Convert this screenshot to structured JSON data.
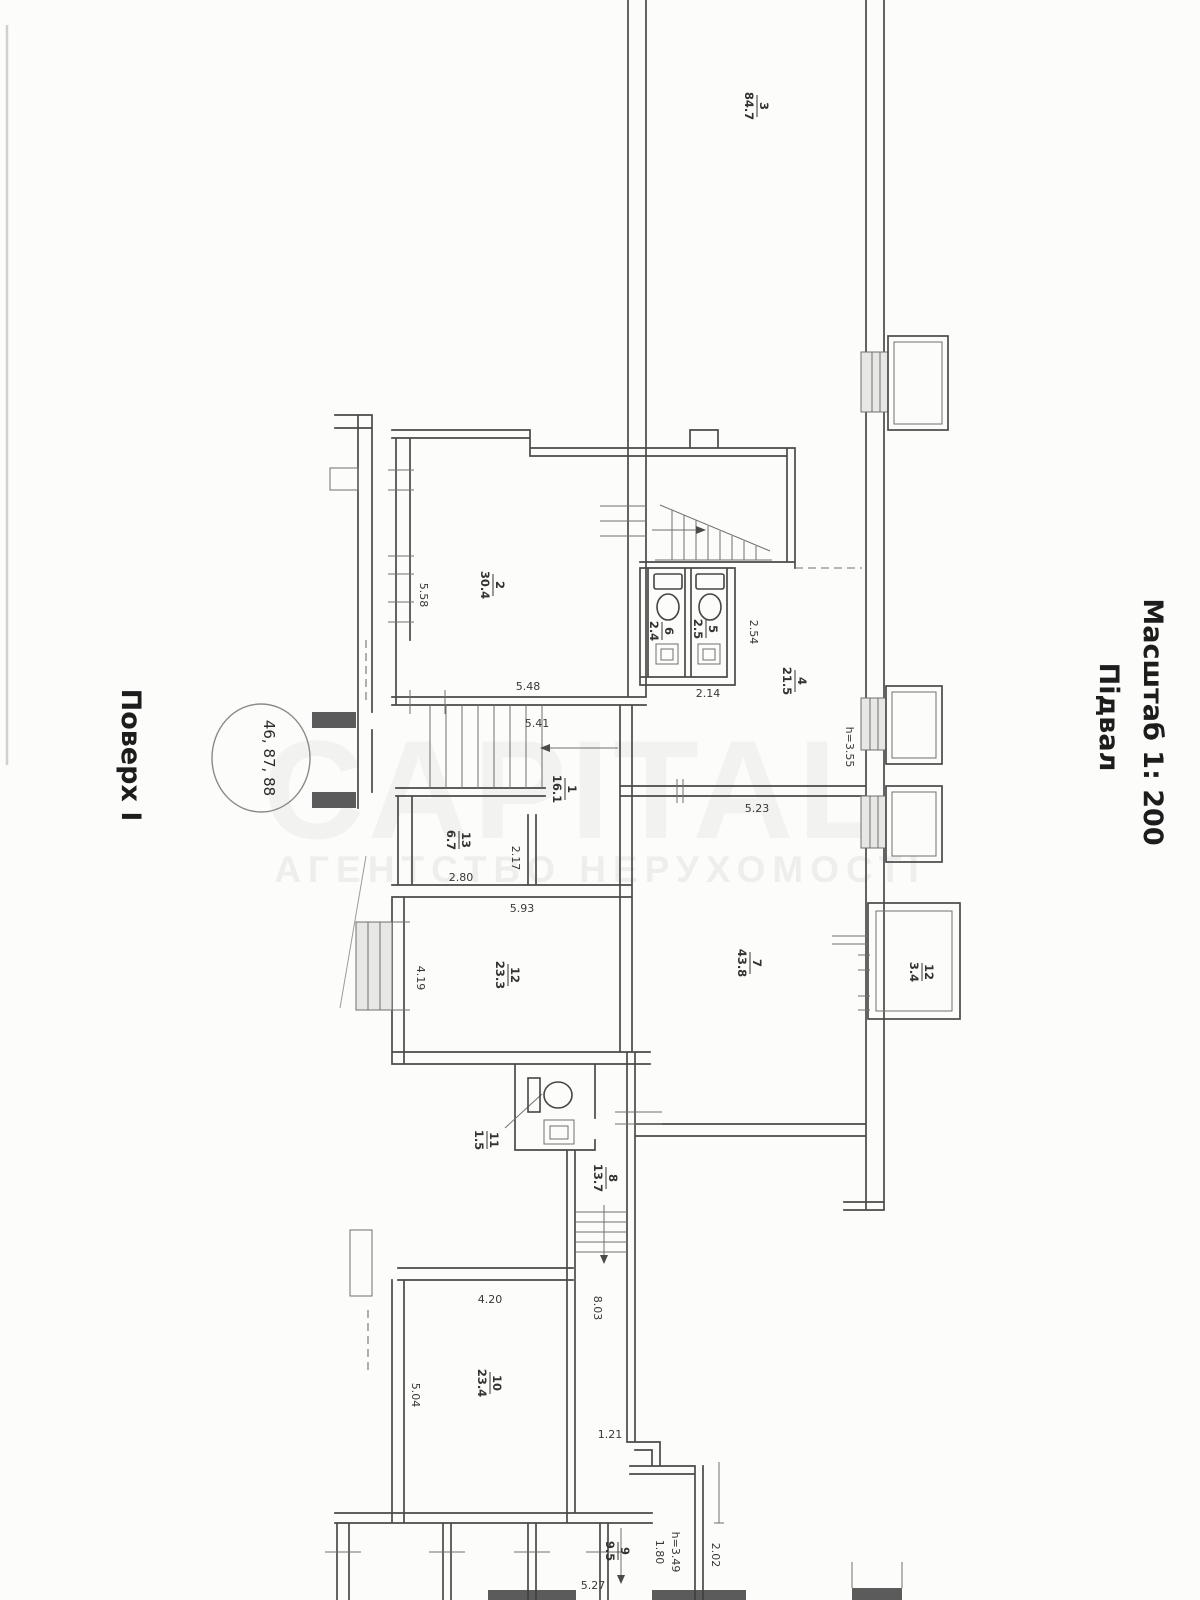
{
  "header": {
    "floor_label": "Поверх I",
    "stamp_numbers": "46, 87, 88",
    "scale_label": "Масштаб 1: 200",
    "level_label": "Підвал"
  },
  "watermark": {
    "brand": "CAPITAL",
    "subtitle": "АГЕНТСТВО НЕРУХОМОСТІ"
  },
  "plan": {
    "type": "basement floor plan, scanned technical drawing rotated 90°",
    "colors": {
      "ink": "#4a4a4a",
      "paper": "#fcfcfb",
      "watermark": "rgba(70,70,70,0.06)"
    },
    "rooms": [
      {
        "number": "1",
        "area": "16.1"
      },
      {
        "number": "2",
        "area": "30.4"
      },
      {
        "number": "3",
        "area": "84.7"
      },
      {
        "number": "4",
        "area": "21.5"
      },
      {
        "number": "5",
        "area": "2.5"
      },
      {
        "number": "6",
        "area": "2.4"
      },
      {
        "number": "7",
        "area": "43.8"
      },
      {
        "number": "8",
        "area": "13.7"
      },
      {
        "number": "9",
        "area": "9.5"
      },
      {
        "number": "10",
        "area": "23.4"
      },
      {
        "number": "11",
        "area": "1.5"
      },
      {
        "number": "12",
        "area": "23.3"
      },
      {
        "number": "12",
        "area": "3.4"
      },
      {
        "number": "13",
        "area": "6.7"
      }
    ],
    "dims": [
      {
        "text": "5.58"
      },
      {
        "text": "5.48"
      },
      {
        "text": "5.41"
      },
      {
        "text": "2.54"
      },
      {
        "text": "2.14"
      },
      {
        "text": "2.17"
      },
      {
        "text": "2.80"
      },
      {
        "text": "5.93"
      },
      {
        "text": "5.23"
      },
      {
        "text": "h=3.55"
      },
      {
        "text": "4.19"
      },
      {
        "text": "8.03"
      },
      {
        "text": "4.20"
      },
      {
        "text": "5.04"
      },
      {
        "text": "1.21"
      },
      {
        "text": "5.27"
      },
      {
        "text": "1.80"
      },
      {
        "text": "h=3.49"
      },
      {
        "text": "2.02"
      }
    ]
  }
}
